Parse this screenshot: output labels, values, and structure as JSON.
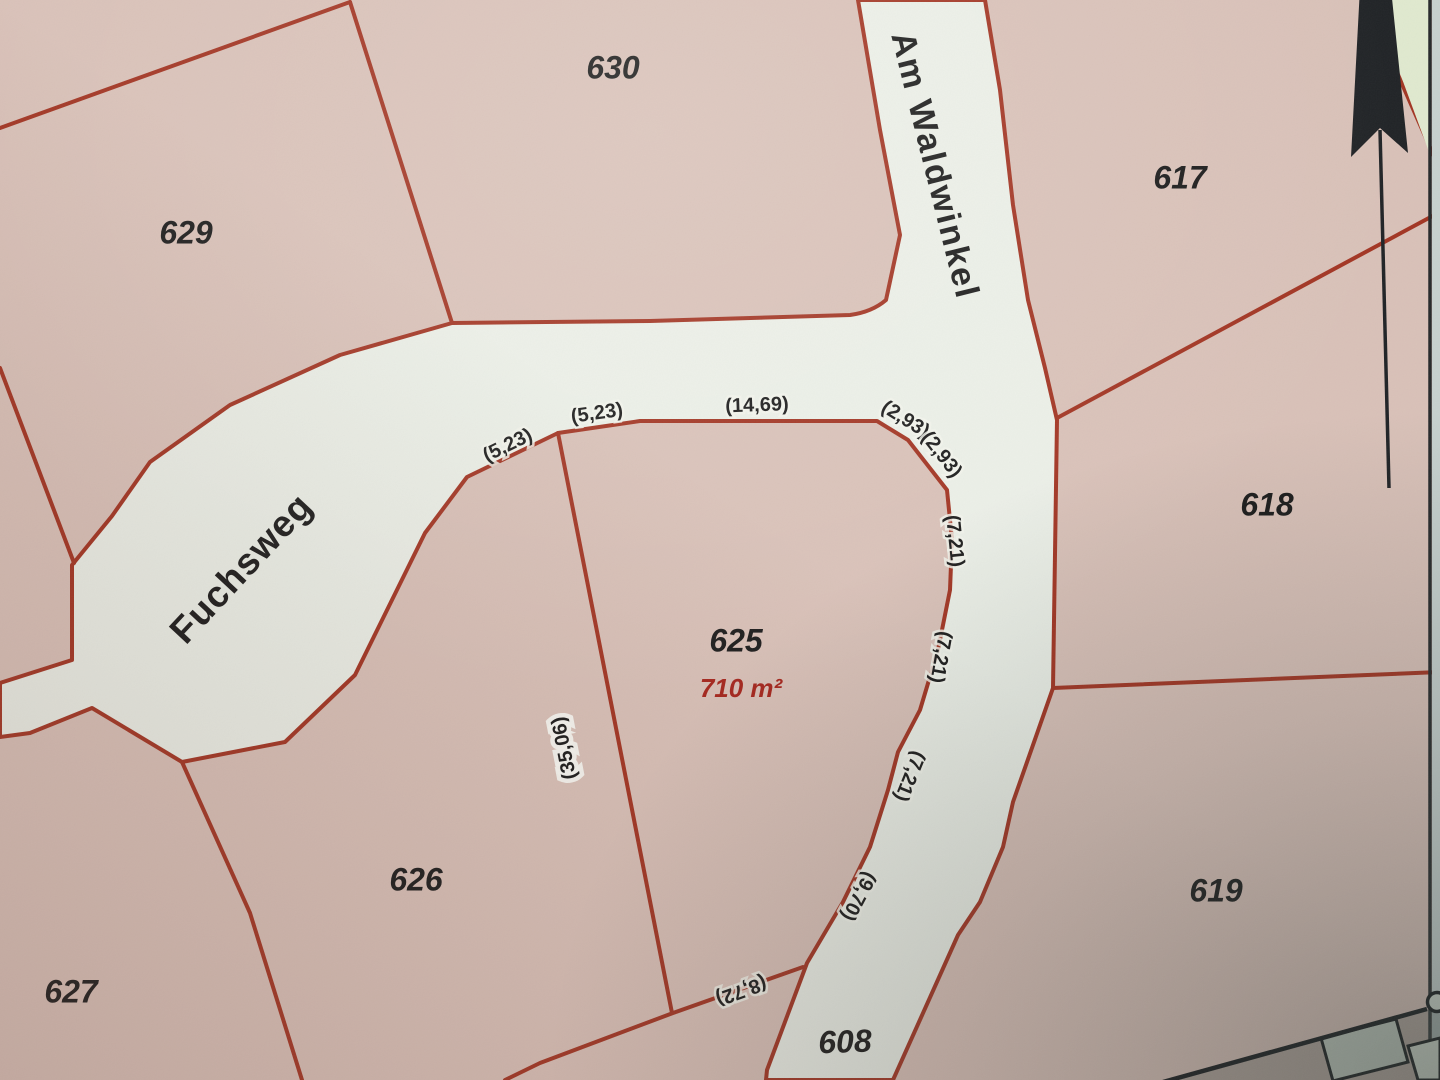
{
  "map": {
    "type": "cadastral-parcel-map",
    "streets": [
      "Fuchsweg",
      "Am Waldwinkel"
    ],
    "parcels": [
      "608",
      "617",
      "618",
      "619",
      "625",
      "626",
      "627",
      "629",
      "630"
    ],
    "highlighted_parcel": {
      "number": "625",
      "area": "710 m²"
    },
    "boundary_measurements": [
      "(5,23)",
      "(5,23)",
      "(14,69)",
      "(2,93)",
      "(2,93)",
      "(7,21)",
      "(7,21)",
      "(7,21)",
      "(9,70)",
      "(8,72)",
      "(35,06)"
    ],
    "colors": {
      "paper_pink": "#d9c1b8",
      "street_fill": "#ebefe7",
      "boundary_red": "#a23422",
      "label_black": "#1b1b1b",
      "area_red": "#a6251c",
      "margin_gray": "#c7d1cf",
      "green_patch": "#e0e9cf",
      "building_gray": "#bcc5ba"
    },
    "labels": [
      {
        "name": "street-label-am-waldwinkel",
        "kind": "street-name",
        "text": "Am Waldwinkel",
        "x": 933,
        "y": 166,
        "rot": 76
      },
      {
        "name": "street-label-fuchsweg",
        "kind": "street-name-lg",
        "text": "Fuchsweg",
        "x": 243,
        "y": 570,
        "rot": -47
      },
      {
        "name": "parcel-label-629",
        "kind": "parcel-number",
        "text": "629",
        "x": 186,
        "y": 235,
        "rot": 0
      },
      {
        "name": "parcel-label-630",
        "kind": "parcel-number",
        "text": "630",
        "x": 613,
        "y": 70,
        "rot": 0
      },
      {
        "name": "parcel-label-617",
        "kind": "parcel-number",
        "text": "617",
        "x": 1180,
        "y": 180,
        "rot": 0
      },
      {
        "name": "parcel-label-618",
        "kind": "parcel-number",
        "text": "618",
        "x": 1267,
        "y": 507,
        "rot": 0
      },
      {
        "name": "parcel-label-619",
        "kind": "parcel-number",
        "text": "619",
        "x": 1216,
        "y": 893,
        "rot": 0
      },
      {
        "name": "parcel-label-625",
        "kind": "parcel-number",
        "text": "625",
        "x": 736,
        "y": 643,
        "rot": 0
      },
      {
        "name": "parcel-label-626",
        "kind": "parcel-number",
        "text": "626",
        "x": 416,
        "y": 882,
        "rot": 0
      },
      {
        "name": "parcel-label-627",
        "kind": "parcel-number",
        "text": "627",
        "x": 71,
        "y": 994,
        "rot": 0
      },
      {
        "name": "parcel-label-608",
        "kind": "parcel-number",
        "text": "608",
        "x": 845,
        "y": 1044,
        "rot": -2
      },
      {
        "name": "area-label-625",
        "kind": "area-value",
        "text": "710 m²",
        "x": 741,
        "y": 690,
        "rot": 0
      },
      {
        "name": "measurement-5-23-a",
        "kind": "measurement",
        "text": "(5,23)",
        "x": 508,
        "y": 446,
        "rot": -26
      },
      {
        "name": "measurement-5-23-b",
        "kind": "measurement",
        "text": "(5,23)",
        "x": 597,
        "y": 414,
        "rot": -8
      },
      {
        "name": "measurement-14-69",
        "kind": "measurement",
        "text": "(14,69)",
        "x": 757,
        "y": 406,
        "rot": -2
      },
      {
        "name": "measurement-2-93-a",
        "kind": "measurement",
        "text": "(2,93)",
        "x": 905,
        "y": 420,
        "rot": 32
      },
      {
        "name": "measurement-2-93-b",
        "kind": "measurement",
        "text": "(2,93)",
        "x": 941,
        "y": 455,
        "rot": 52
      },
      {
        "name": "measurement-7-21-a",
        "kind": "measurement",
        "text": "(7,21)",
        "x": 954,
        "y": 541,
        "rot": 84
      },
      {
        "name": "measurement-7-21-b",
        "kind": "measurement",
        "text": "(7,21)",
        "x": 940,
        "y": 657,
        "rot": 100
      },
      {
        "name": "measurement-7-21-c",
        "kind": "measurement",
        "text": "(7,21)",
        "x": 909,
        "y": 776,
        "rot": 112
      },
      {
        "name": "measurement-9-70",
        "kind": "measurement",
        "text": "(9,70)",
        "x": 858,
        "y": 896,
        "rot": 118
      },
      {
        "name": "measurement-8-72",
        "kind": "measurement",
        "text": "(8,72)",
        "x": 741,
        "y": 990,
        "rot": 160
      },
      {
        "name": "measurement-35-06",
        "kind": "measurement measurement-halo",
        "text": "(35,06)",
        "x": 565,
        "y": 748,
        "rot": -101
      }
    ]
  }
}
